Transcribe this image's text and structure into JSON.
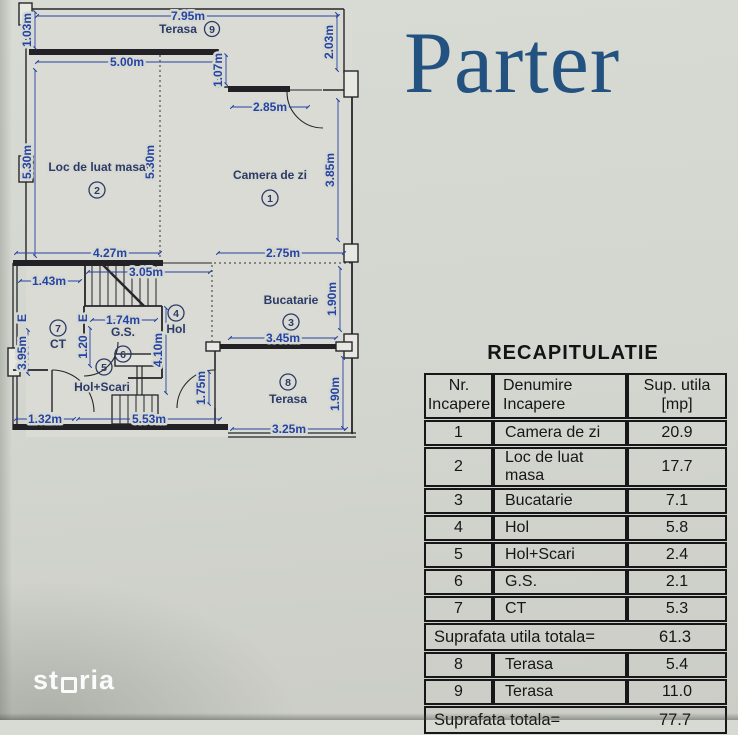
{
  "title": "Parter",
  "watermark": {
    "pre": "st",
    "post": "ria"
  },
  "colors": {
    "paper": "#d5d6d1",
    "title_blue": "#235180",
    "dim_blue": "#2543a2",
    "label_navy": "#2c3a66",
    "wall_ink": "#26262b",
    "table_ink": "#161616",
    "watermark_white": "#ffffff"
  },
  "plan": {
    "rooms": {
      "r1": {
        "n": "1",
        "name": "Camera de zi"
      },
      "r2": {
        "n": "2",
        "name": "Loc de luat masa"
      },
      "r3": {
        "n": "3",
        "name": "Bucatarie"
      },
      "r4": {
        "n": "4",
        "name": "Hol"
      },
      "r5": {
        "n": "5",
        "name": "Hol+Scari"
      },
      "r6": {
        "n": "6",
        "name": "G.S."
      },
      "r7": {
        "n": "7",
        "name": "CT"
      },
      "r8": {
        "n": "8",
        "name": "Terasa"
      },
      "r9": {
        "n": "9",
        "name": "Terasa"
      }
    },
    "dims": {
      "w795": "7.95m",
      "h103": "1.03m",
      "w500": "5.00m",
      "h107": "1.07m",
      "w285": "2.85m",
      "h203": "2.03m",
      "h530l": "5.30m",
      "h530m": "5.30m",
      "h385": "3.85m",
      "w427": "4.27m",
      "w275": "2.75m",
      "w143": "1.43m",
      "w305": "3.05m",
      "h190a": "1.90m",
      "w174": "1.74m",
      "h410": "4.10m",
      "h120": "1.20",
      "e1": "E",
      "e2": "E",
      "h395": "3.95m",
      "w345": "3.45m",
      "h175": "1.75m",
      "h190b": "1.90m",
      "w132": "1.32m",
      "w553": "5.53m",
      "w325": "3.25m"
    }
  },
  "table": {
    "title": "RECAPITULATIE",
    "headers": [
      "Nr. Incapere",
      "Denumire Incapere",
      "Sup. utila [mp]"
    ],
    "rows": [
      [
        "1",
        "Camera de zi",
        "20.9"
      ],
      [
        "2",
        "Loc de luat masa",
        "17.7"
      ],
      [
        "3",
        "Bucatarie",
        "7.1"
      ],
      [
        "4",
        "Hol",
        "5.8"
      ],
      [
        "5",
        "Hol+Scari",
        "2.4"
      ],
      [
        "6",
        "G.S.",
        "2.1"
      ],
      [
        "7",
        "CT",
        "5.3"
      ]
    ],
    "subtotal": {
      "label": "Suprafata utila totala=",
      "value": "61.3"
    },
    "rows2": [
      [
        "8",
        "Terasa",
        "5.4"
      ],
      [
        "9",
        "Terasa",
        "11.0"
      ]
    ],
    "total": {
      "label": "Suprafata totala=",
      "value": "77.7"
    }
  }
}
